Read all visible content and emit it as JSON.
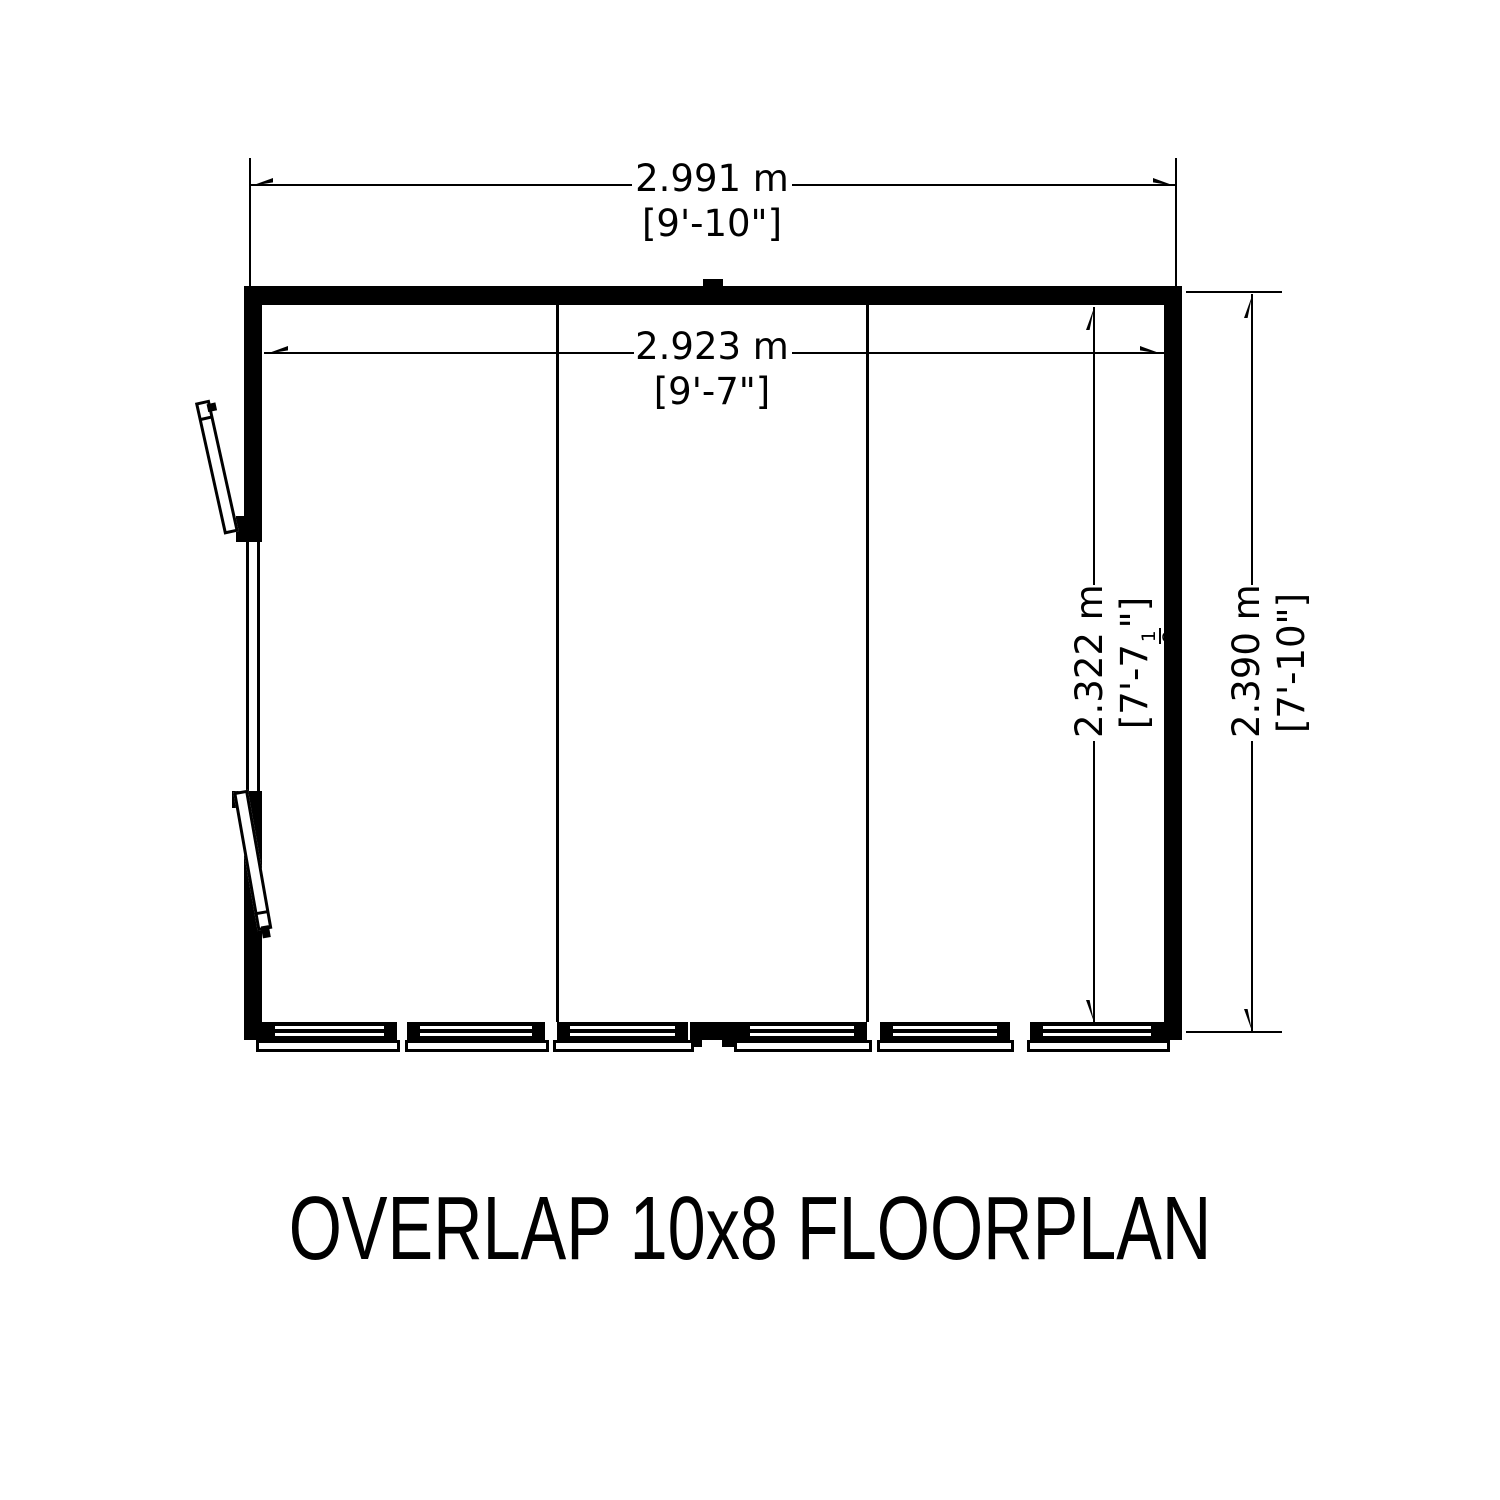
{
  "title": "OVERLAP 10x8 FLOORPLAN",
  "colors": {
    "line": "#000000",
    "background": "#ffffff"
  },
  "dimensions": {
    "external_width": {
      "metric": "2.991 m",
      "imperial": "[9'-10\"]"
    },
    "internal_width": {
      "metric": "2.923 m",
      "imperial": "[9'-7\"]"
    },
    "internal_depth": {
      "metric": "2.322 m",
      "imperial_prefix": "[7'-7",
      "fraction_numerator": "1",
      "fraction_denominator": "2",
      "imperial_suffix": "\"]"
    },
    "external_depth": {
      "metric": "2.390 m",
      "imperial": "[7'-10\"]"
    }
  }
}
